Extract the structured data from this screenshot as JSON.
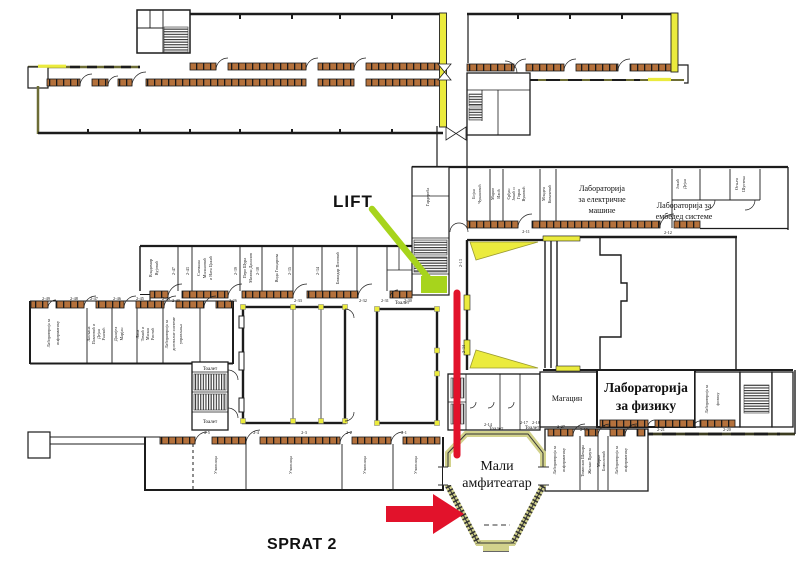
{
  "annotations": {
    "lift": "LIFT",
    "floor": "SPRAT 2"
  },
  "colors": {
    "wall": "#1c1c1c",
    "olive_wall": "#6d6d35",
    "window_brown": "#b4713c",
    "accent_yellow": "#ebeb3d",
    "khaki_wall": "#d2d28c",
    "highlight_green": "#a7d41c",
    "highlight_red": "#e2122b"
  },
  "labels": {
    "mali_1": "Мали",
    "mali_2": "амфитеатар",
    "fizika_1": "Лабораторија",
    "fizika_2": "за физику",
    "fizika_small_1": "Лабораторија за",
    "fizika_small_2": "физику",
    "magacin": "Магацин",
    "elmasine_1": "Лабораторија",
    "elmasine_2": "за електричне",
    "elmasine_3": "машине",
    "embedded_1": "Лабораторија за",
    "embedded_2": "ембедед системе",
    "informatika_1": "Лабораторија за",
    "informatika_2": "информатику",
    "digsys_1": "Лабораторија за",
    "digsys_2": "дигиталне системе",
    "digsys_3": "управљања",
    "ucionica": "Учионица",
    "toalet": "Тоалет",
    "garderoba": "Гардероба"
  },
  "offices": {
    "a1": [
      "Бојан",
      "Чукановић"
    ],
    "a2": [
      "Марио",
      "Илић"
    ],
    "a3": [
      "Срђан",
      "Јокић и",
      "Горан",
      "Вуковић"
    ],
    "a4": [
      "Младен",
      "Ковачевић"
    ],
    "a5": [
      "Јокић",
      "Дејан"
    ],
    "a6": [
      "Огњен",
      "Шустека"
    ],
    "b1": [
      "Владимир",
      "Вујовић"
    ],
    "b2": [
      "Снежана",
      "Милановић",
      "и Ната Цакић"
    ],
    "b3": [
      "Перо Шура",
      "Милош Данилов"
    ],
    "b4": [
      "Вида Гонџарова"
    ],
    "b5": [
      "Божидар Поповић"
    ],
    "c1": [
      "Љиљана",
      "Павловић и",
      "Дејан",
      "Ранчић"
    ],
    "c2": [
      "Данијел",
      "Марјан"
    ],
    "c3": [
      "Лана",
      "Томић и",
      "Милан",
      "Ристић"
    ],
    "d1": [
      "Томислав Шекара",
      "Жељко Прауза"
    ],
    "d2": [
      "Мирко",
      "Божиловић"
    ]
  },
  "numbers": {
    "labs": [
      "2-11",
      "2-12"
    ],
    "mid_doors": [
      "2-47",
      "2-43",
      "2-39",
      "2-38",
      "2-35",
      "2-34"
    ],
    "mid_corridor": [
      "2-40",
      "2-36",
      "2-33",
      "2-32",
      "2-31",
      "2-30"
    ],
    "west": [
      "2-49",
      "2-48",
      "2-47",
      "2-46",
      "2-45",
      "2-44"
    ],
    "classrooms": [
      "2-5",
      "2-4",
      "2-3",
      "2-2",
      "2-1"
    ],
    "physics": [
      "2-19",
      "2-21",
      "2-20"
    ],
    "south_labs": [
      "2-27",
      "2-25",
      "2-26"
    ],
    "toilets": [
      "2-14",
      "2-17",
      "2-18"
    ],
    "corridor": [
      "2-13",
      "2-34"
    ]
  }
}
